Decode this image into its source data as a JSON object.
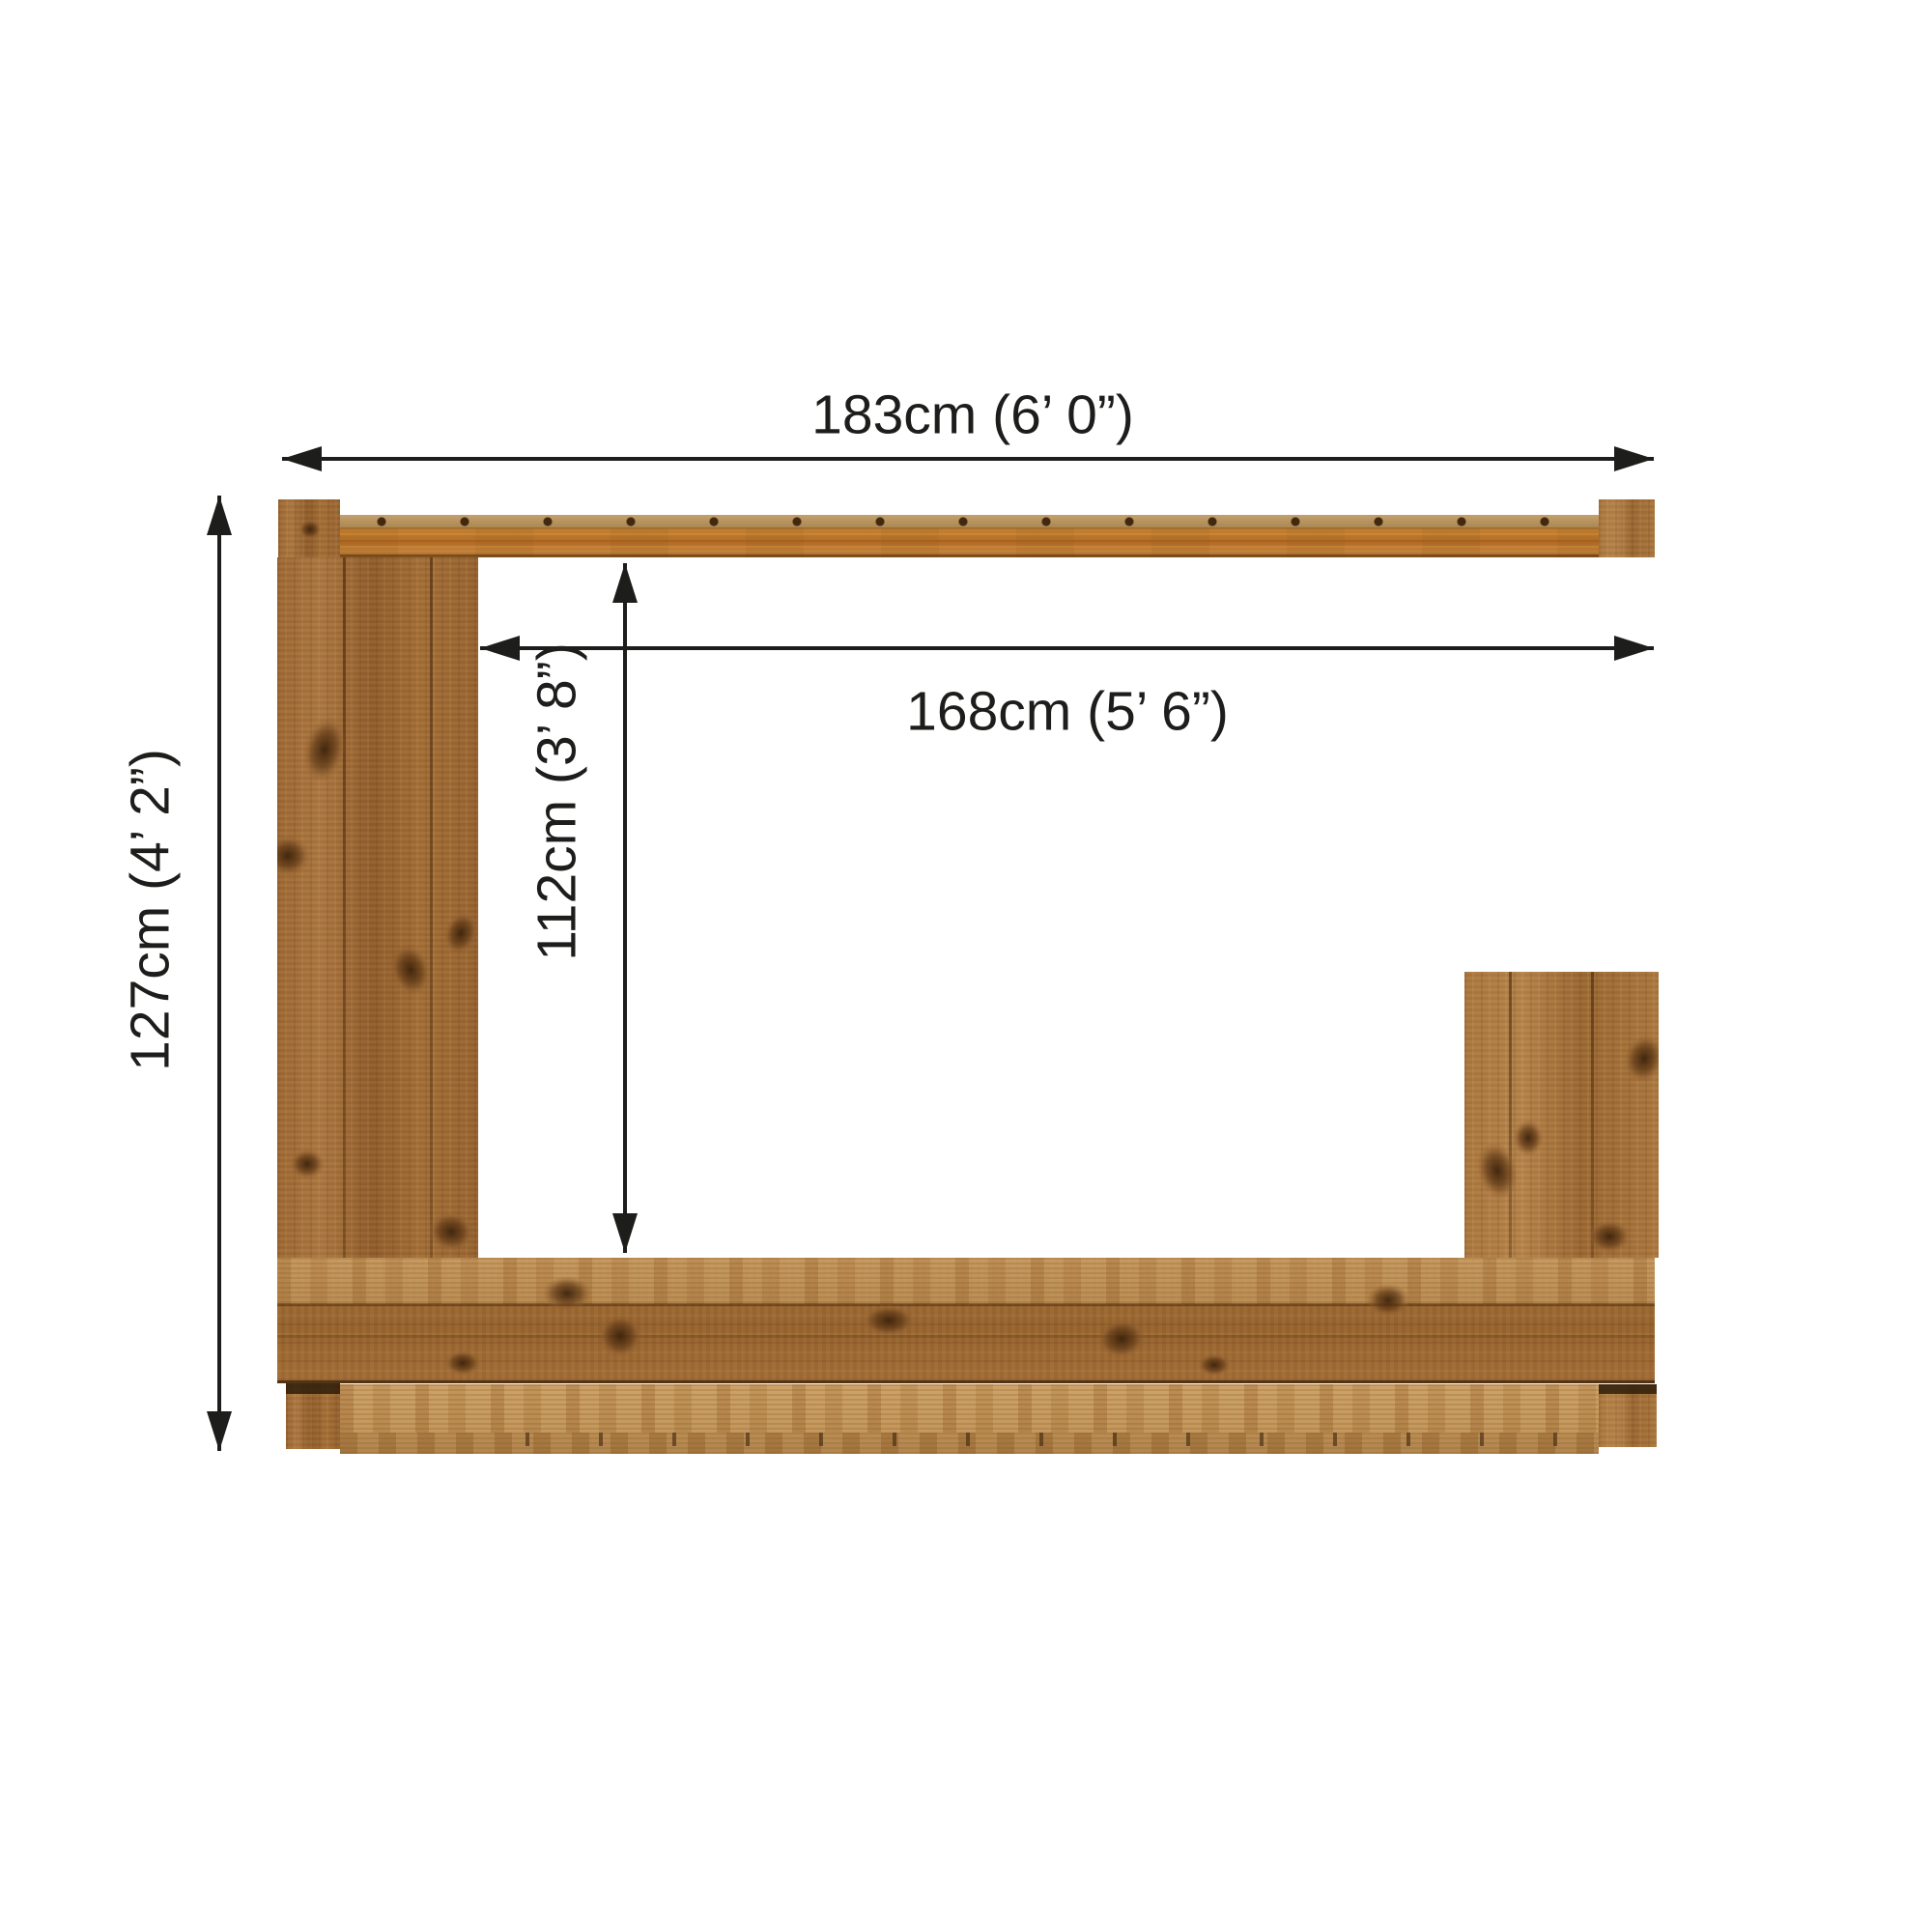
{
  "page": {
    "type": "product-dimension-diagram",
    "subject": "wooden garden bar front elevation with serving hatch",
    "background": "#ffffff"
  },
  "dimensions": {
    "total_width": {
      "label": "183cm (6’ 0”)",
      "orientation": "horizontal"
    },
    "hatch_width": {
      "label": "168cm (5’ 6”)",
      "orientation": "horizontal"
    },
    "total_height": {
      "label": "127cm (4’ 2”)",
      "orientation": "vertical"
    },
    "hatch_height": {
      "label": "112cm (3’ 8”)",
      "orientation": "vertical"
    }
  },
  "colors": {
    "dimension_ink": "#1d1d1b",
    "background": "#ffffff",
    "wood_panel": "#9a6531",
    "wood_top_beam": "#c5812f",
    "wood_base_rail": "#bb8e53"
  }
}
